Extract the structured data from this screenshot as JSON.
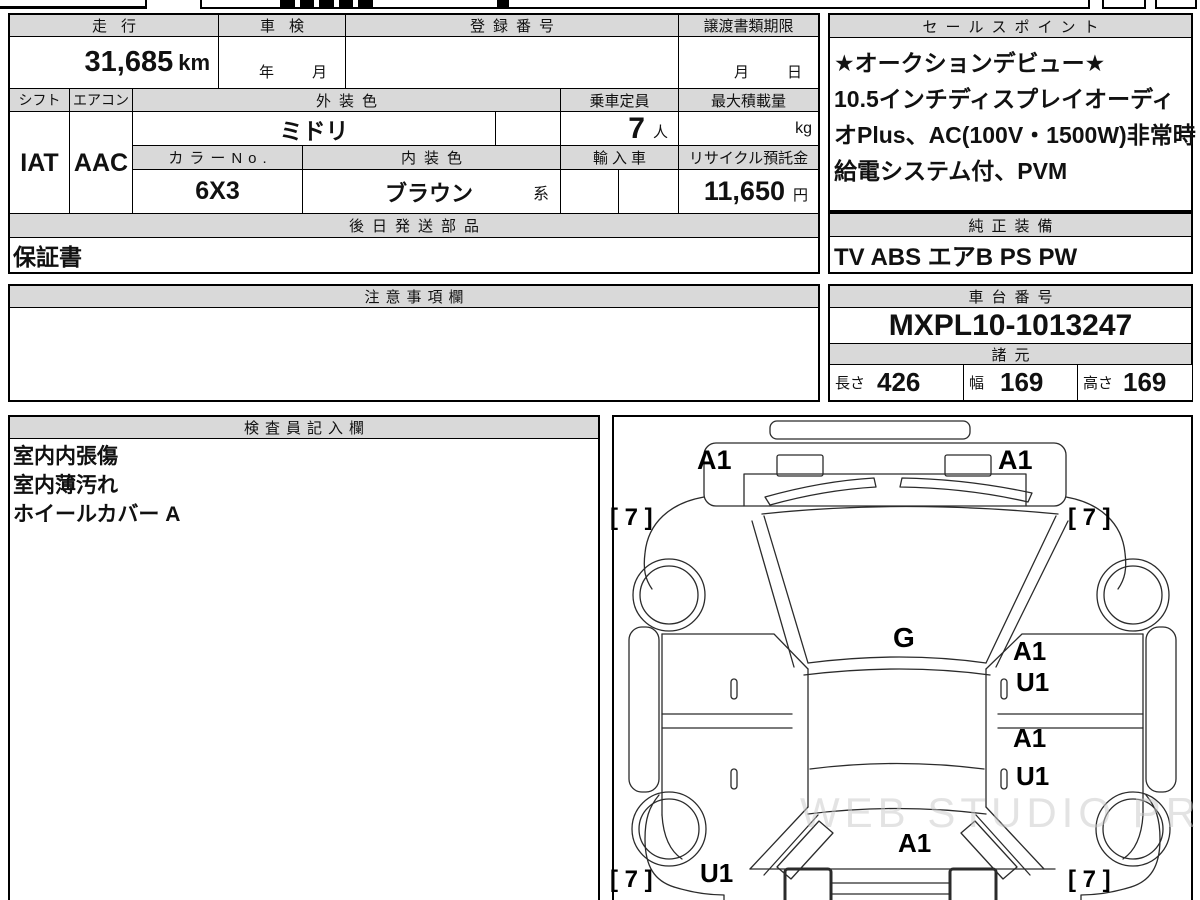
{
  "table": {
    "soukou_label": "走行",
    "soukou_value": "31,685",
    "soukou_unit": "km",
    "shaken_label": "車検",
    "shaken_year": "年",
    "shaken_month": "月",
    "touroku_label": "登録番号",
    "jouto_label": "譲渡書類期限",
    "jouto_month": "月",
    "jouto_day": "日",
    "shift_label": "シフト",
    "shift_value": "IAT",
    "aircon_label": "エアコン",
    "aircon_value": "AAC",
    "gaisou_label": "外装色",
    "gaisou_value": "ミドリ",
    "teiin_label": "乗車定員",
    "teiin_value": "7",
    "teiin_unit": "人",
    "saidai_label": "最大積載量",
    "saidai_unit": "kg",
    "colorno_label": "カラーNo.",
    "colorno_value": "6X3",
    "naisou_label": "内装色",
    "naisou_value": "ブラウン",
    "naisou_suffix": "系",
    "yunyu_label": "輸入車",
    "recycle_label": "リサイクル預託金",
    "recycle_value": "11,650",
    "recycle_unit": "円",
    "gojitsu_label": "後日発送部品",
    "gojitsu_value": "保証書"
  },
  "sales": {
    "label": "セールスポイント",
    "lines": [
      "★オークションデビュー★",
      "10.5インチディスプレイオーディ",
      "オPlus、AC(100V・1500W)非常時",
      "給電システム付、PVM"
    ]
  },
  "equipment": {
    "label": "純正装備",
    "value": "TV ABS エアB PS PW"
  },
  "notes_box": {
    "label": "注意事項欄"
  },
  "chassis": {
    "label": "車台番号",
    "value": "MXPL10-1013247"
  },
  "specs": {
    "label": "諸元",
    "length_label": "長さ",
    "length_value": "426",
    "width_label": "幅",
    "width_value": "169",
    "height_label": "高さ",
    "height_value": "169"
  },
  "inspector": {
    "label": "検査員記入欄",
    "note1": "室内内張傷",
    "note2": "室内薄汚れ",
    "note3": "ホイールカバー A"
  },
  "diagram": {
    "watermark": "WEB STUDIO PRO",
    "labels": {
      "front_left": "A1",
      "front_right": "A1",
      "tire_front_left": "[ 7 ]",
      "tire_front_right": "[ 7 ]",
      "glass": "G",
      "door_right_front": "A1",
      "door_right_front2": "U1",
      "door_right_rear": "A1",
      "door_right_rear2": "U1",
      "rear_gate": "A1",
      "rear_quarter_left": "U1",
      "tire_rear_left": "[ 7 ]",
      "tire_rear_right": "[ 7 ]"
    }
  },
  "colors": {
    "header_bg": "#d9d9d9",
    "line": "#000000"
  }
}
